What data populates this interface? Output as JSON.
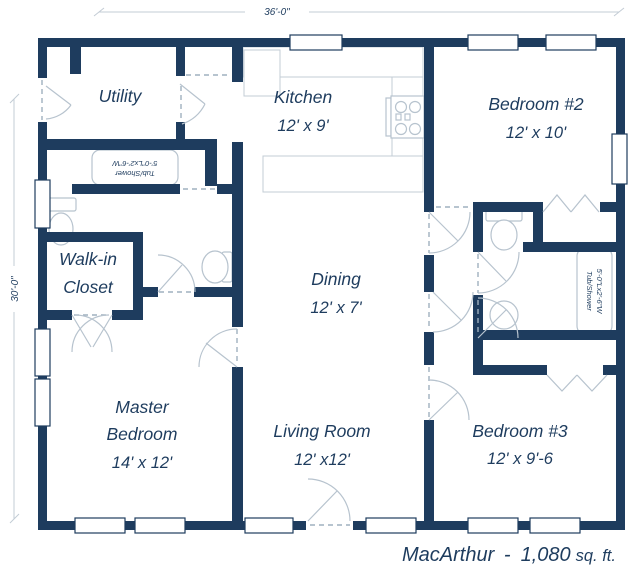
{
  "dimensions": {
    "width_label": "36'-0\"",
    "height_label": "30'-0\""
  },
  "rooms": {
    "utility": {
      "name": "Utility"
    },
    "kitchen": {
      "name": "Kitchen",
      "size": "12' x 9'"
    },
    "bedroom2": {
      "name": "Bedroom #2",
      "size": "12' x 10'"
    },
    "walkin": {
      "line1": "Walk-in",
      "line2": "Closet"
    },
    "dining": {
      "name": "Dining",
      "size": "12' x 7'"
    },
    "master": {
      "line1": "Master",
      "line2": "Bedroom",
      "size": "14' x 12'"
    },
    "living": {
      "name": "Living Room",
      "size": "12' x12'"
    },
    "bedroom3": {
      "name": "Bedroom #3",
      "size": "12' x 9'-6"
    }
  },
  "fixtures": {
    "tub_left": {
      "line1": "Tub/Shower",
      "line2": "5'-0\"Lx2'-6\"W"
    },
    "tub_right": {
      "line1": "5'-0\"Lx2'-6\"W",
      "line2": "Tub/Shower"
    }
  },
  "caption": {
    "name": "MacArthur",
    "separator": "-",
    "area": "1,080",
    "unit": "sq. ft."
  },
  "colors": {
    "wall": "#1e3c5e",
    "text": "#1e3c5e",
    "fixture_line": "#b7c3ce",
    "dash_line": "#9fb0bf"
  }
}
